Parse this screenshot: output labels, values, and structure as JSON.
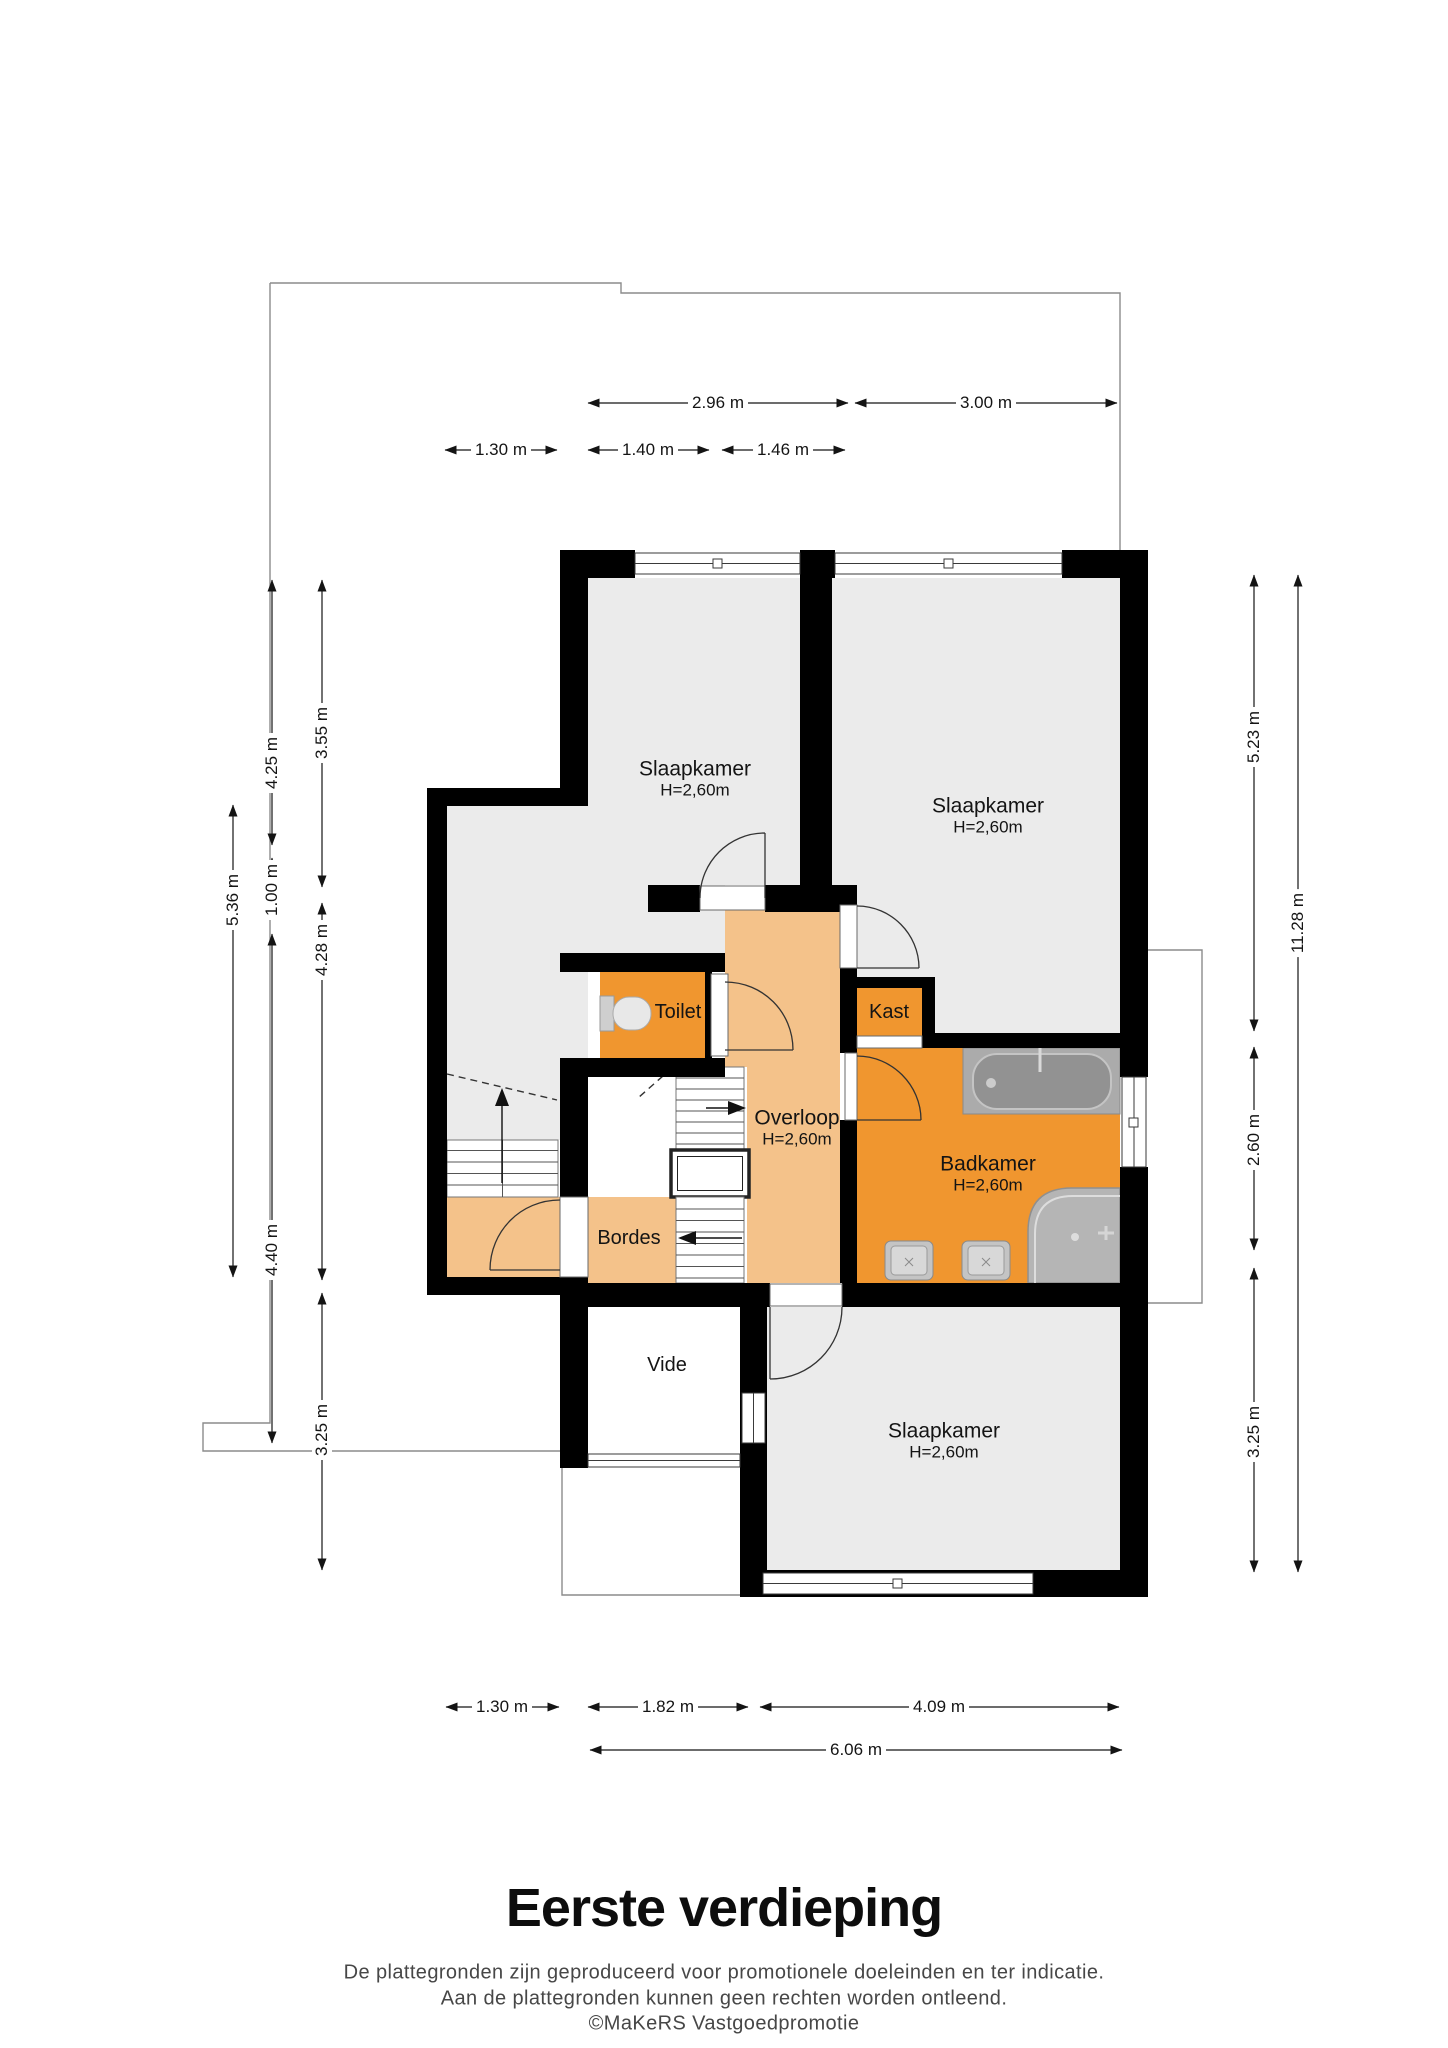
{
  "title": "Eerste verdieping",
  "footer": {
    "line1": "De plattegronden zijn geproduceerd voor promotionele doeleinden en ter indicatie.",
    "line2": "Aan de plattegronden kunnen geen rechten worden ontleend.",
    "line3": "©MaKeRS Vastgoedpromotie"
  },
  "rooms": {
    "slaapkamer1": {
      "name": "Slaapkamer",
      "height": "H=2,60m"
    },
    "slaapkamer2": {
      "name": "Slaapkamer",
      "height": "H=2,60m"
    },
    "slaapkamer3": {
      "name": "Slaapkamer",
      "height": "H=2,60m"
    },
    "badkamer": {
      "name": "Badkamer",
      "height": "H=2,60m"
    },
    "overloop": {
      "name": "Overloop",
      "height": "H=2,60m"
    },
    "toilet": {
      "name": "Toilet"
    },
    "kast": {
      "name": "Kast"
    },
    "bordes": {
      "name": "Bordes"
    },
    "vide": {
      "name": "Vide"
    }
  },
  "dimensions": {
    "top": {
      "d296": "2.96 m",
      "d300": "3.00 m",
      "d130": "1.30 m",
      "d140": "1.40 m",
      "d146": "1.46 m"
    },
    "left": {
      "d425": "4.25 m",
      "d355": "3.55 m",
      "d536": "5.36 m",
      "d100": "1.00 m",
      "d428": "4.28 m",
      "d440": "4.40 m",
      "d325": "3.25 m"
    },
    "right": {
      "d523": "5.23 m",
      "d1128": "11.28 m",
      "d260": "2.60 m",
      "d325": "3.25 m"
    },
    "bottom": {
      "d130": "1.30 m",
      "d182": "1.82 m",
      "d409": "4.09 m",
      "d606": "6.06 m"
    }
  },
  "colors": {
    "wall": "#000000",
    "room_accent_orange": "#f0962f",
    "room_light_orange": "#f4c28a",
    "room_gray": "#ebebeb",
    "fixture_gray": "#b5b5b5",
    "outline_gray": "#8c8c8c",
    "text": "#141414"
  }
}
